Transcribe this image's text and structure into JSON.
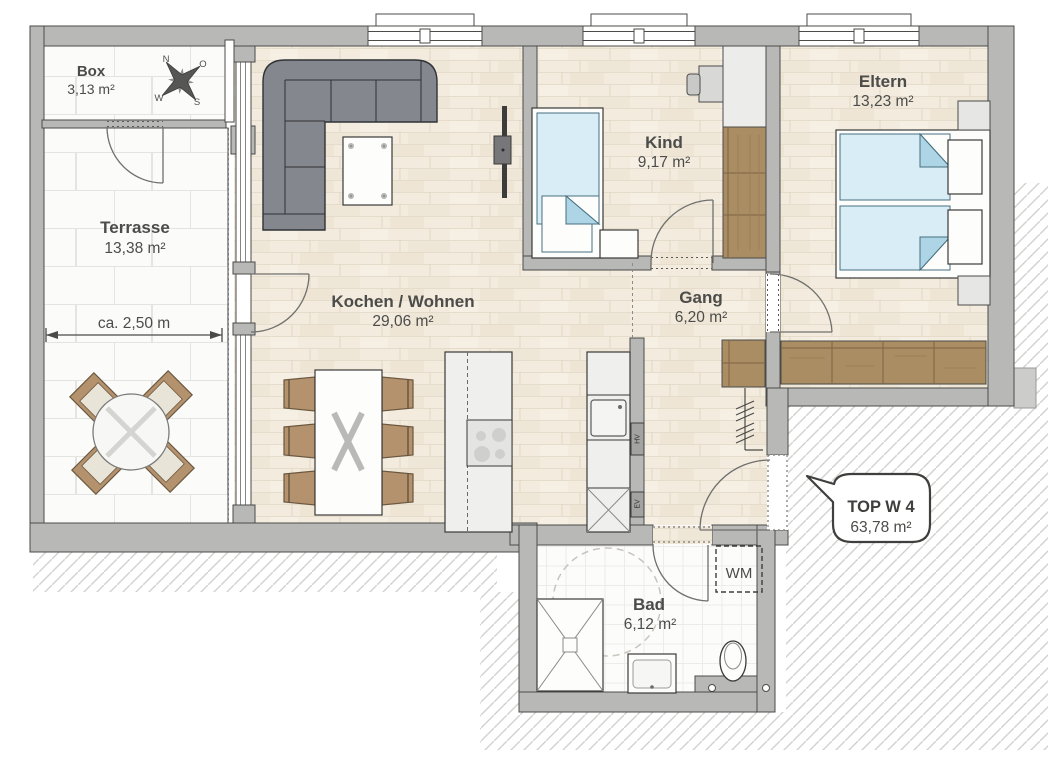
{
  "rooms": {
    "box": {
      "name": "Box",
      "area": "3,13 m²"
    },
    "terrasse": {
      "name": "Terrasse",
      "area": "13,38 m²"
    },
    "kochen_wohnen": {
      "name": "Kochen / Wohnen",
      "area": "29,06 m²"
    },
    "kind": {
      "name": "Kind",
      "area": "9,17 m²"
    },
    "eltern": {
      "name": "Eltern",
      "area": "13,23 m²"
    },
    "gang": {
      "name": "Gang",
      "area": "6,20 m²"
    },
    "bad": {
      "name": "Bad",
      "area": "6,12 m²"
    }
  },
  "unit_callout": {
    "title": "TOP W 4",
    "area": "63,78 m²"
  },
  "dimension": {
    "terrasse_width": "ca. 2,50 m"
  },
  "labels": {
    "washing_machine": "WM",
    "hv": "HV",
    "ev": "EV"
  },
  "compass": {
    "north": "N",
    "east": "O",
    "south": "S",
    "west": "W"
  },
  "colors": {
    "wall": "#b8b8b6",
    "outline": "#4b4b49",
    "wood_floor": "#f2ebde",
    "tile_floor": "#fbfbf9",
    "furniture_wood": "#ab8d64",
    "bed_blue": "#d9edf6",
    "sofa_gray": "#84878e",
    "hatch_line": "#d2d2d0"
  }
}
